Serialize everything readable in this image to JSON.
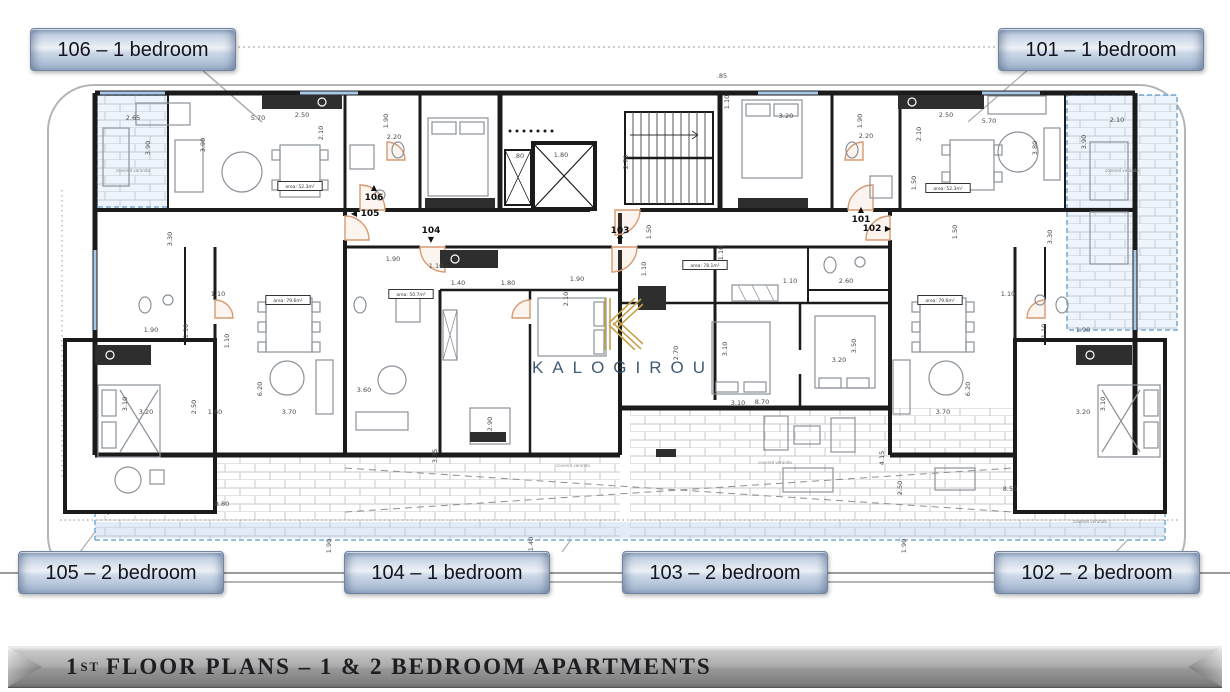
{
  "callouts": {
    "unit_106": "106 – 1 bedroom",
    "unit_101": "101 – 1 bedroom",
    "unit_105": "105 – 2 bedroom",
    "unit_104": "104 – 1 bedroom",
    "unit_103": "103 – 2 bedroom",
    "unit_102": "102 – 2 bedroom"
  },
  "banner": {
    "number": "1",
    "ordinal": "ST",
    "title": "FLOOR PLANS – 1 & 2 BEDROOM APARTMENTS"
  },
  "watermark": {
    "name": "KALOGIROU"
  },
  "colors": {
    "button_border": "#70859f",
    "veranda_blue": "#74a9d6",
    "window_blue": "#a9c7e8",
    "door_arc": "#d79a72",
    "watermark_navy": "#2e4a66",
    "watermark_gold": "#c6a14f",
    "banner_text": "#1d1d22"
  },
  "plan": {
    "unit_markers": [
      {
        "label": "106",
        "x": 374,
        "y": 200,
        "arrow": "up"
      },
      {
        "label": "105",
        "x": 370,
        "y": 216,
        "arrow": "left"
      },
      {
        "label": "104",
        "x": 431,
        "y": 233,
        "arrow": "down"
      },
      {
        "label": "103",
        "x": 620,
        "y": 233,
        "arrow": "down"
      },
      {
        "label": "102",
        "x": 872,
        "y": 231,
        "arrow": "right"
      },
      {
        "label": "101",
        "x": 861,
        "y": 222,
        "arrow": "up"
      }
    ],
    "area_labels": [
      {
        "t": "area: 52.3m²",
        "x": 300,
        "y": 188
      },
      {
        "t": "area: 52.3m²",
        "x": 948,
        "y": 190
      },
      {
        "t": "area: 79.6m²",
        "x": 288,
        "y": 302
      },
      {
        "t": "area: 50.7m²",
        "x": 411,
        "y": 296
      },
      {
        "t": "area: 78.1m²",
        "x": 705,
        "y": 267
      },
      {
        "t": "area: 79.6m²",
        "x": 940,
        "y": 302
      }
    ],
    "tiny_labels": [
      {
        "t": "covered veranda",
        "x": 133,
        "y": 172
      },
      {
        "t": "covered veranda",
        "x": 1122,
        "y": 172
      },
      {
        "t": "covered veranda",
        "x": 573,
        "y": 467
      },
      {
        "t": "covered veranda",
        "x": 775,
        "y": 464
      },
      {
        "t": "covered veranda",
        "x": 1090,
        "y": 523
      }
    ],
    "dimensions": [
      {
        "t": "2.65",
        "x": 133,
        "y": 120
      },
      {
        "t": "5.70",
        "x": 258,
        "y": 120
      },
      {
        "t": "2.50",
        "x": 302,
        "y": 117
      },
      {
        "t": "2.10",
        "x": 323,
        "y": 133,
        "r": 1
      },
      {
        "t": "1.90",
        "x": 388,
        "y": 121,
        "r": 1
      },
      {
        "t": "2.20",
        "x": 394,
        "y": 139
      },
      {
        "t": "3.90",
        "x": 150,
        "y": 148,
        "r": 1
      },
      {
        "t": "3.90",
        "x": 205,
        "y": 145,
        "r": 1
      },
      {
        "t": ".85",
        "x": 722,
        "y": 78
      },
      {
        "t": "1.10",
        "x": 729,
        "y": 102,
        "r": 1
      },
      {
        "t": ".80",
        "x": 519,
        "y": 158
      },
      {
        "t": "1.80",
        "x": 561,
        "y": 157
      },
      {
        "t": "2.70",
        "x": 628,
        "y": 162,
        "r": 1
      },
      {
        "t": "3.20",
        "x": 786,
        "y": 118
      },
      {
        "t": "1.90",
        "x": 862,
        "y": 121,
        "r": 1
      },
      {
        "t": "2.20",
        "x": 866,
        "y": 138
      },
      {
        "t": "2.50",
        "x": 946,
        "y": 117
      },
      {
        "t": "5.70",
        "x": 989,
        "y": 123
      },
      {
        "t": "2.10",
        "x": 921,
        "y": 134,
        "r": 1
      },
      {
        "t": "3.80",
        "x": 1037,
        "y": 148,
        "r": 1
      },
      {
        "t": "3.90",
        "x": 1086,
        "y": 142,
        "r": 1
      },
      {
        "t": "2.10",
        "x": 1117,
        "y": 122
      },
      {
        "t": "1.50",
        "x": 916,
        "y": 183,
        "r": 1
      },
      {
        "t": "1.90",
        "x": 393,
        "y": 261
      },
      {
        "t": "1.10",
        "x": 436,
        "y": 268
      },
      {
        "t": "1.40",
        "x": 458,
        "y": 285
      },
      {
        "t": "1.80",
        "x": 508,
        "y": 285
      },
      {
        "t": "1.90",
        "x": 577,
        "y": 281
      },
      {
        "t": "2.10",
        "x": 568,
        "y": 299,
        "r": 1
      },
      {
        "t": "1.50",
        "x": 651,
        "y": 232,
        "r": 1
      },
      {
        "t": "1.10",
        "x": 646,
        "y": 269,
        "r": 1
      },
      {
        "t": "1.10",
        "x": 723,
        "y": 253,
        "r": 1
      },
      {
        "t": "1.10",
        "x": 218,
        "y": 296
      },
      {
        "t": "1.90",
        "x": 151,
        "y": 332
      },
      {
        "t": "1.10",
        "x": 188,
        "y": 331,
        "r": 1
      },
      {
        "t": "1.10",
        "x": 229,
        "y": 341,
        "r": 1
      },
      {
        "t": "3.30",
        "x": 172,
        "y": 239,
        "r": 1
      },
      {
        "t": "3.10",
        "x": 127,
        "y": 404,
        "r": 1
      },
      {
        "t": "3.20",
        "x": 146,
        "y": 414
      },
      {
        "t": "2.50",
        "x": 196,
        "y": 407,
        "r": 1
      },
      {
        "t": "1.60",
        "x": 215,
        "y": 414
      },
      {
        "t": "3.70",
        "x": 289,
        "y": 414
      },
      {
        "t": "6.20",
        "x": 262,
        "y": 389,
        "r": 1
      },
      {
        "t": "8.80",
        "x": 222,
        "y": 506
      },
      {
        "t": "3.60",
        "x": 364,
        "y": 392
      },
      {
        "t": "2.90",
        "x": 492,
        "y": 424,
        "r": 1
      },
      {
        "t": "3.35",
        "x": 437,
        "y": 456,
        "r": 1
      },
      {
        "t": "1.10",
        "x": 790,
        "y": 283
      },
      {
        "t": "2.60",
        "x": 846,
        "y": 283
      },
      {
        "t": "2.70",
        "x": 678,
        "y": 353,
        "r": 1
      },
      {
        "t": "3.10",
        "x": 727,
        "y": 349,
        "r": 1
      },
      {
        "t": "3.10",
        "x": 738,
        "y": 405
      },
      {
        "t": "3.50",
        "x": 856,
        "y": 346,
        "r": 1
      },
      {
        "t": "3.20",
        "x": 839,
        "y": 362
      },
      {
        "t": "8.70",
        "x": 762,
        "y": 404
      },
      {
        "t": "4.15",
        "x": 884,
        "y": 458,
        "r": 1
      },
      {
        "t": "1.50",
        "x": 957,
        "y": 232,
        "r": 1
      },
      {
        "t": "1.10",
        "x": 1008,
        "y": 296
      },
      {
        "t": "1.90",
        "x": 1083,
        "y": 332
      },
      {
        "t": "1.10",
        "x": 1046,
        "y": 331,
        "r": 1
      },
      {
        "t": "3.30",
        "x": 1052,
        "y": 237,
        "r": 1
      },
      {
        "t": "3.10",
        "x": 1105,
        "y": 404,
        "r": 1
      },
      {
        "t": "3.20",
        "x": 1083,
        "y": 414
      },
      {
        "t": "3.70",
        "x": 943,
        "y": 414
      },
      {
        "t": "6.20",
        "x": 970,
        "y": 389,
        "r": 1
      },
      {
        "t": "2.50",
        "x": 902,
        "y": 488,
        "r": 1
      },
      {
        "t": "8.50",
        "x": 1010,
        "y": 491
      },
      {
        "t": "1.90",
        "x": 331,
        "y": 546,
        "r": 1
      },
      {
        "t": "1.40",
        "x": 533,
        "y": 544,
        "r": 1
      },
      {
        "t": "1.90",
        "x": 906,
        "y": 546,
        "r": 1
      }
    ]
  }
}
